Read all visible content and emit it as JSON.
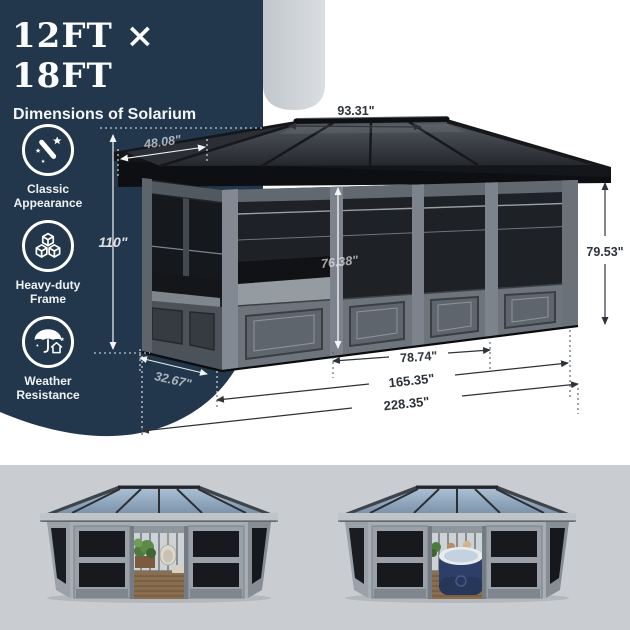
{
  "panel": {
    "title": "12FT × 18FT",
    "subtitle": "Dimensions of Solarium",
    "features": [
      {
        "icon": "magic-wand-icon",
        "line1": "Classic",
        "line2": "Appearance"
      },
      {
        "icon": "cubes-icon",
        "line1": "Heavy-duty",
        "line2": "Frame"
      },
      {
        "icon": "umbrella-house-icon",
        "line1": "Weather",
        "line2": "Resistance"
      }
    ]
  },
  "dims": {
    "ridge_width": "93.31\"",
    "roof_slope": "48.08\"",
    "total_height": "110\"",
    "door_height": "76.38\"",
    "wall_height": "79.53\"",
    "door_width": "78.74\"",
    "side_depth": "32.67\"",
    "base_width": "165.35\"",
    "total_width": "228.35\""
  },
  "colors": {
    "panel_navy": "#22374c",
    "accent_band": "#ccd1d6",
    "bottom_strip": "#c9cdd1",
    "roof_dark": "#1d2024",
    "frame_gray": "#7d838c",
    "label_dark": "#2e333a",
    "label_light": "#ffffff",
    "glass_blue": "#9db3c8",
    "hot_tub_navy": "#2d3f68"
  }
}
